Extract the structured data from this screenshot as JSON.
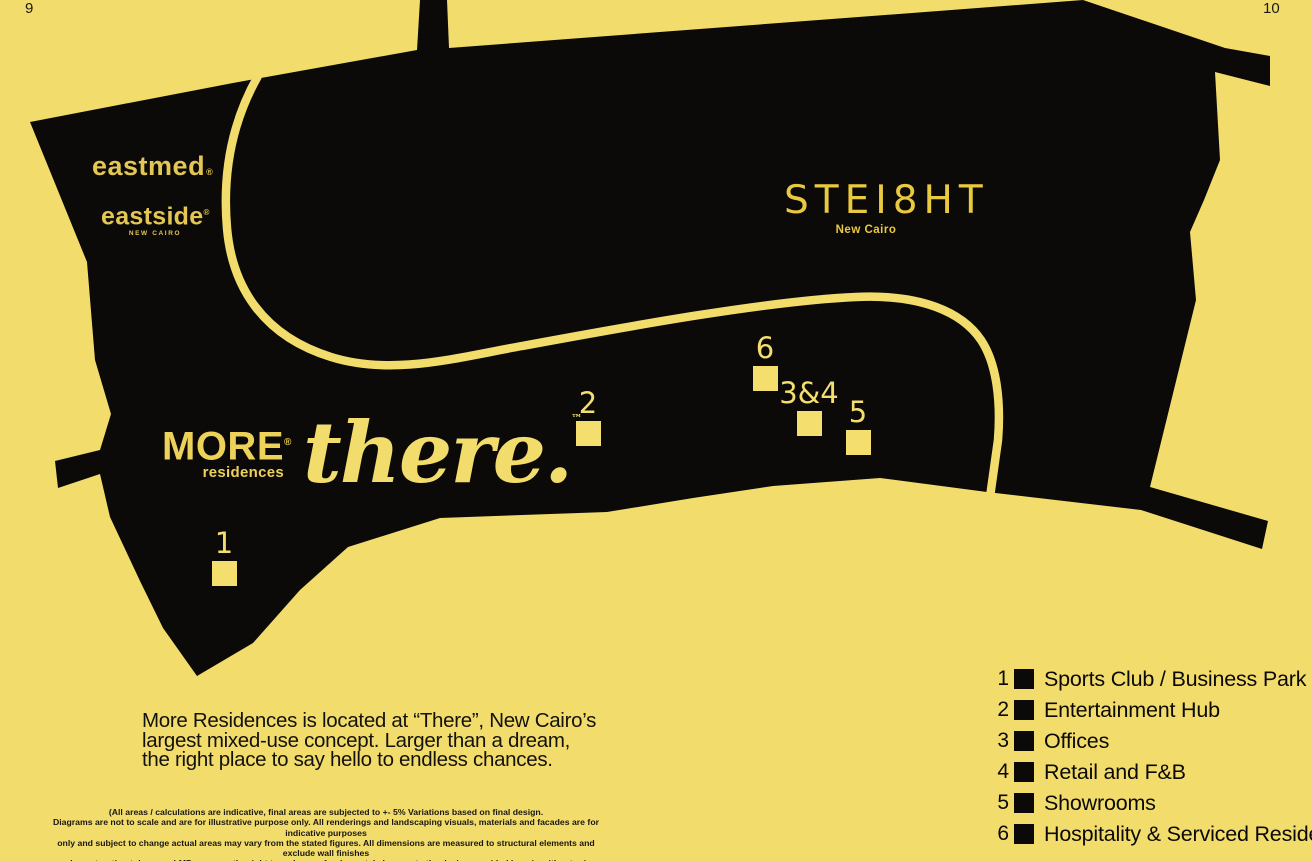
{
  "page": {
    "left_page_number": "9",
    "right_page_number": "10"
  },
  "colors": {
    "background": "#f2dc6b",
    "map_black": "#0b0a08",
    "road_yellow": "#f2dc6b",
    "marker_yellow": "#f4de6e",
    "eastmed_eastside_logo": "#e3c654",
    "more_logo": "#edd25a",
    "there_logo": "#f2dc6b",
    "steight_logo": "#e8c93f",
    "body_text": "#14120e"
  },
  "map": {
    "logos": {
      "eastmed": {
        "name": "eastmed",
        "reg": "®"
      },
      "eastside": {
        "name": "eastside",
        "reg": "®",
        "tagline": "NEW CAIRO"
      },
      "more": {
        "name": "MORE",
        "reg": "®",
        "tagline": "residences"
      },
      "there": {
        "name": "there.",
        "tm": "™"
      },
      "steight": {
        "name": "STEI8HT",
        "tagline": "New Cairo"
      }
    },
    "markers": [
      {
        "label": "1"
      },
      {
        "label": "2"
      },
      {
        "label": "6"
      },
      {
        "label": "3&4"
      },
      {
        "label": "5"
      }
    ]
  },
  "description": {
    "lines": [
      "More Residences is located at “There”, New Cairo’s",
      "largest mixed-use concept. Larger than a dream,",
      "the right place to say hello to endless chances."
    ]
  },
  "disclaimer": {
    "lines": [
      "(All areas / calculations are indicative, final areas are subjected to +- 5% Variations based on final design.",
      "Diagrams are not to scale and are for illustrative purpose only. All renderings and landscaping visuals, materials and facades are for indicative purposes",
      "only and subject to change actual areas may vary from the stated figures. All dimensions are measured to structural elements and exclude wall finishes",
      "and construction tolerance. LMD reserves the right to make non fundamental changes to the design provided here in without prior notice)."
    ]
  },
  "legend": {
    "items": [
      {
        "number": "1",
        "label": "Sports Club / Business Park"
      },
      {
        "number": "2",
        "label": "Entertainment Hub"
      },
      {
        "number": "3",
        "label": "Offices"
      },
      {
        "number": "4",
        "label": "Retail and F&B"
      },
      {
        "number": "5",
        "label": "Showrooms"
      },
      {
        "number": "6",
        "label": "Hospitality & Serviced Residences"
      }
    ]
  }
}
